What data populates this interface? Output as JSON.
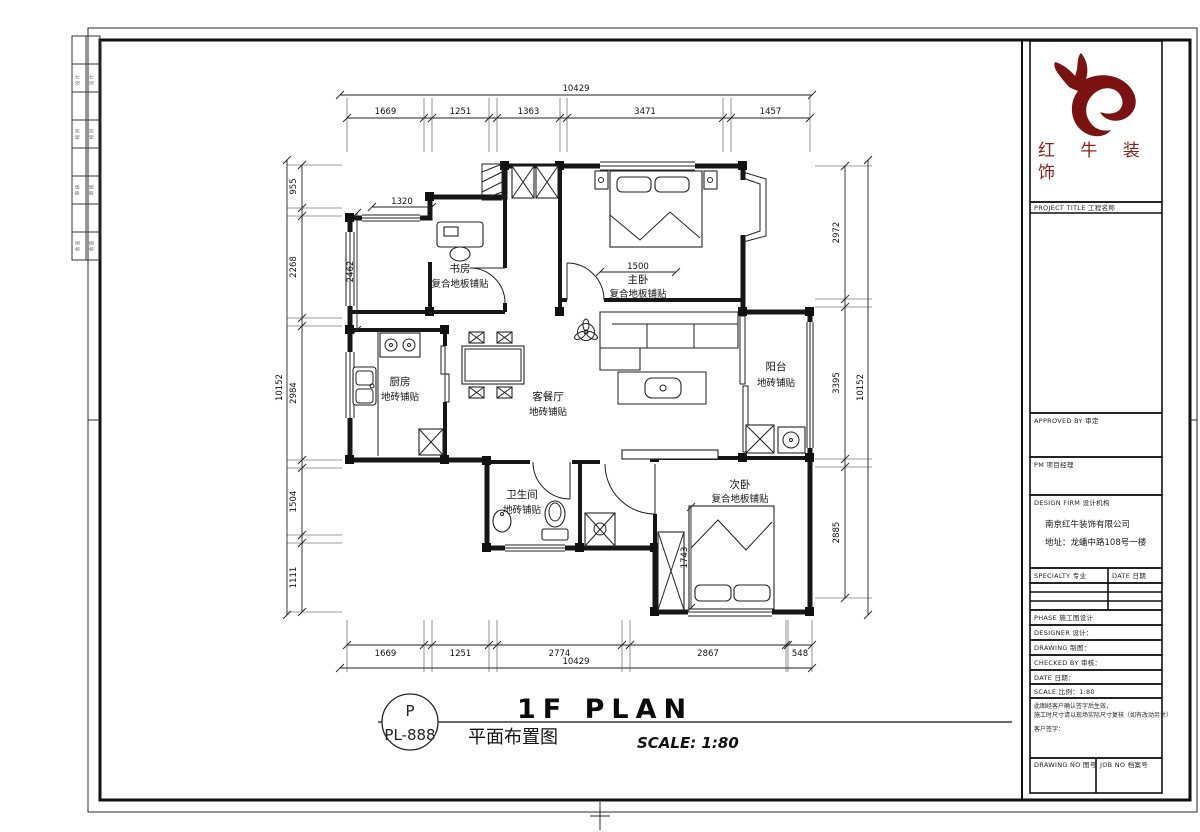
{
  "brand": {
    "logo": "bull-swoosh",
    "logo_color": "#7a1212",
    "name_line1": "红 牛 装",
    "name_line2": "饰"
  },
  "title_block": {
    "project_title_label": "PROJECT TITLE  工程名称",
    "approved_label": "APPROVED BY  审定",
    "pm_label": "PM  项目经理",
    "firm_label": "DESIGN FIRM  设计机构",
    "firm_name": "南京红牛装饰有限公司",
    "firm_address": "地址：龙蟠中路108号一楼",
    "specialty_label": "SPECIALTY  专业",
    "date_label": "DATE  日期",
    "phase_label": "PHASE  施工图设计",
    "designer_label": "DESIGNER  设计：",
    "drawing_label": "DRAWING  制图：",
    "checked_label": "CHECKED BY  审核：",
    "date2_label": "DATE  日期：",
    "scale_label": "SCALE  比例：1:80",
    "notes": [
      "此图经客户确认签字后生效，",
      "施工时尺寸请以现场实际尺寸复核（如有改动另计）",
      "客户签字："
    ],
    "drawing_no_label": "DRAWING NO  图号",
    "job_no_label": "JOB NO  档案号"
  },
  "binding_strip": [
    "设 计",
    "校 对",
    "审 核",
    "会 签"
  ],
  "rooms": {
    "study": {
      "name": "书房",
      "floor": "复合地板铺贴"
    },
    "master": {
      "name": "主卧",
      "floor": "复合地板铺贴"
    },
    "living": {
      "name": "客餐厅",
      "floor": "地砖铺贴"
    },
    "kitchen": {
      "name": "厨房",
      "floor": "地砖铺贴"
    },
    "balcony": {
      "name": "阳台",
      "floor": "地砖铺贴"
    },
    "bath": {
      "name": "卫生间",
      "floor": "地砖铺贴"
    },
    "bed2": {
      "name": "次卧",
      "floor": "复合地板铺贴"
    }
  },
  "dims": {
    "top": {
      "overall": "10429",
      "segments": [
        "1669",
        "1251",
        "1363",
        "3471",
        "1457"
      ]
    },
    "bottom": {
      "overall": "10429",
      "segments": [
        "1669",
        "1251",
        "2774",
        "2867",
        "548"
      ]
    },
    "left": {
      "overall": "10152",
      "segments": [
        "955",
        "2268",
        "2984",
        "1504",
        "1111"
      ]
    },
    "right": {
      "overall": "10152",
      "segments": [
        "2972",
        "3395",
        "2885"
      ]
    },
    "interior": [
      "1320",
      "2462",
      "1500",
      "1743"
    ]
  },
  "titlebar": {
    "badge_letter": "P",
    "badge_code": "PL-888",
    "title_en": "1F PLAN",
    "title_cn": "平面布置图",
    "scale_text": "SCALE: 1:80"
  }
}
